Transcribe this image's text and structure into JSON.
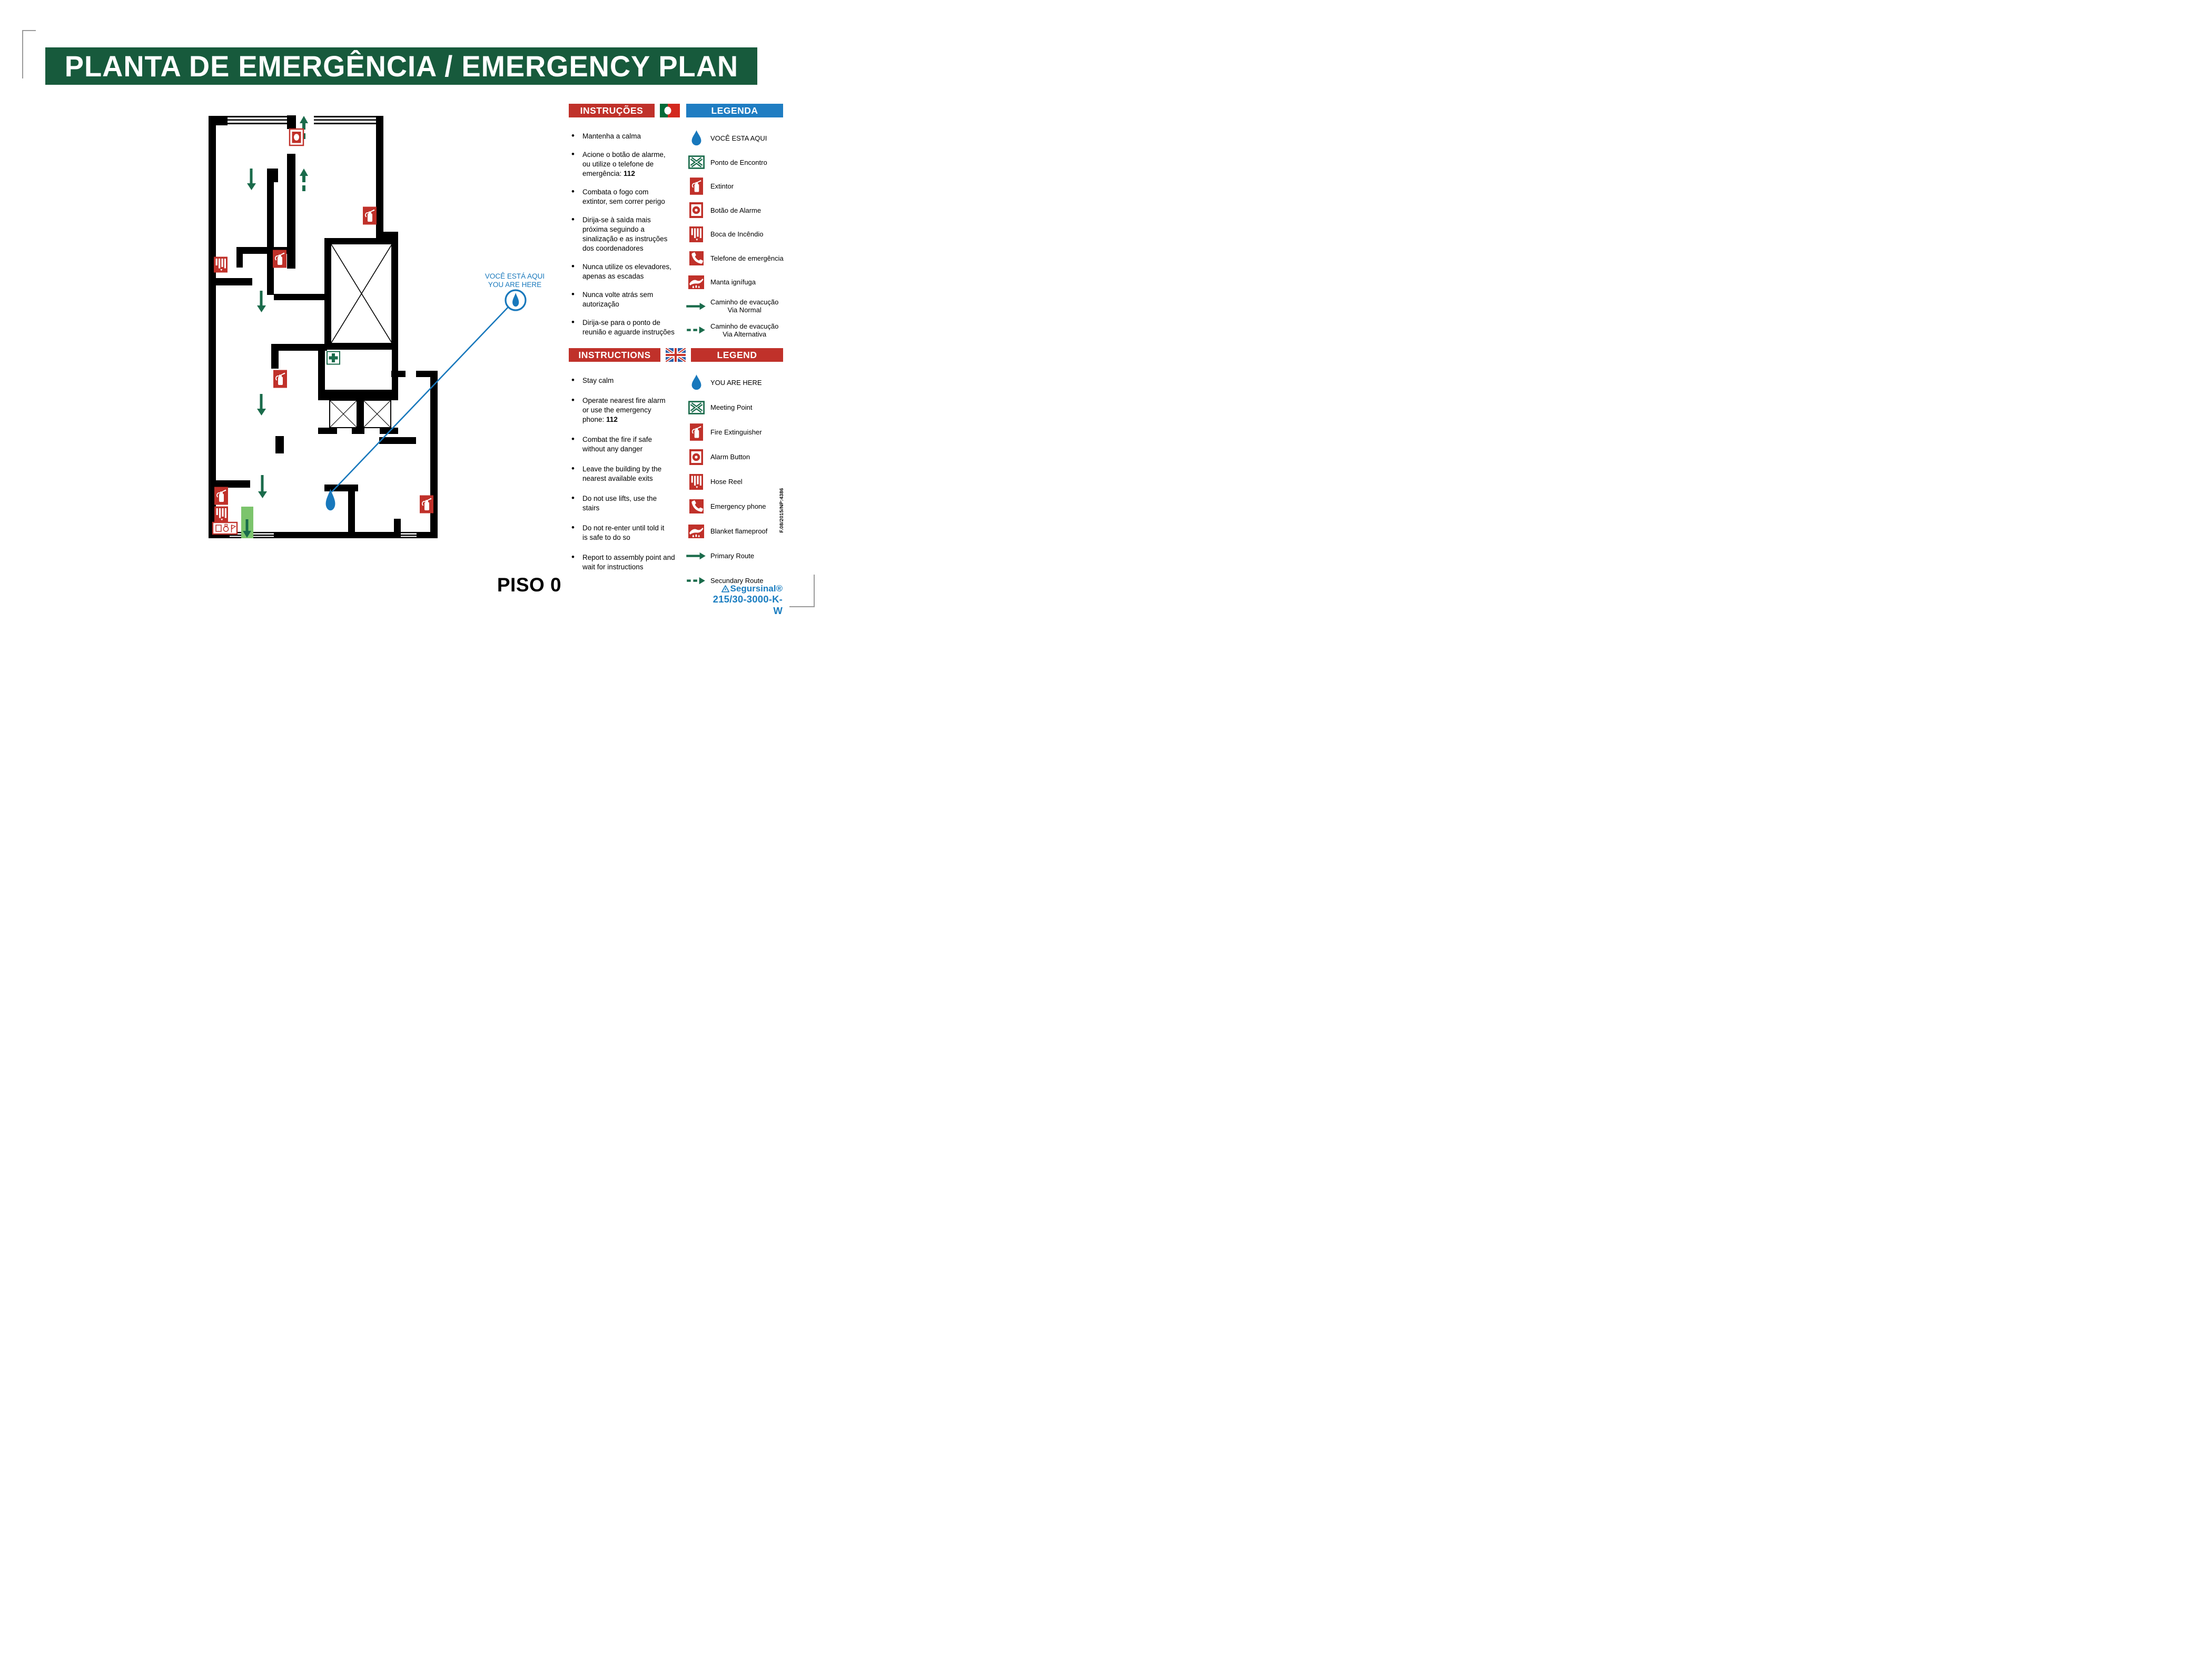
{
  "title": "PLANTA DE EMERGÊNCIA / EMERGENCY PLAN",
  "floor_label": "PISO 0",
  "you_are_here": {
    "line1": "VOCÊ ESTÁ AQUI",
    "line2": "YOU ARE HERE"
  },
  "panels": {
    "pt": {
      "instructions_header": "INSTRUÇÕES",
      "legend_header": "LEGENDA",
      "instructions": [
        {
          "text": "Mantenha a calma"
        },
        {
          "text": "Acione o botão de alarme,\nou utilize o telefone de\nemergência: **112**"
        },
        {
          "text": "Combata o fogo com\nextintor, sem correr perigo"
        },
        {
          "text": "Dirija-se à saìda mais\npróxima seguindo a\nsinalização e as instruções\ndos coordenadores"
        },
        {
          "text": "Nunca utilize os elevadores,\napenas as escadas"
        },
        {
          "text": "Nunca volte atrás sem\nautorização"
        },
        {
          "text": "Dirija-se para o ponto de\nreunião e aguarde instruções"
        }
      ],
      "legend": [
        {
          "icon": "drop",
          "label": "VOCÊ ESTA AQUI"
        },
        {
          "icon": "meeting",
          "label": "Ponto de Encontro"
        },
        {
          "icon": "ext",
          "label": "Extintor"
        },
        {
          "icon": "alarm",
          "label": "Botão de Alarme"
        },
        {
          "icon": "hose",
          "label": "Boca de Incêndio"
        },
        {
          "icon": "phone",
          "label": "Telefone de emergência"
        },
        {
          "icon": "manta",
          "label": "Manta ignífuga"
        },
        {
          "icon": "arrow-solid",
          "label": "Caminho de evacução\nVia Normal"
        },
        {
          "icon": "arrow-dash",
          "label": "Caminho de evacução\nVia Alternativa"
        }
      ]
    },
    "en": {
      "instructions_header": "INSTRUCTIONS",
      "legend_header": "LEGEND",
      "instructions": [
        {
          "text": "Stay calm"
        },
        {
          "text": "Operate nearest fire alarm\nor use the emergency\nphone: **112**"
        },
        {
          "text": "Combat the fire if safe\nwithout any danger"
        },
        {
          "text": "Leave the building by the\nnearest available exits"
        },
        {
          "text": "Do not use lifts, use the\nstairs"
        },
        {
          "text": "Do not re-enter until told it\nis safe to do so"
        },
        {
          "text": "Report to assembly point and\nwait for instructions"
        }
      ],
      "legend": [
        {
          "icon": "drop",
          "label": "YOU ARE HERE"
        },
        {
          "icon": "meeting",
          "label": "Meeting Point"
        },
        {
          "icon": "ext",
          "label": "Fire Extinguisher"
        },
        {
          "icon": "alarm",
          "label": "Alarm Button"
        },
        {
          "icon": "hose",
          "label": "Hose Reel"
        },
        {
          "icon": "phone",
          "label": "Emergency phone"
        },
        {
          "icon": "manta",
          "label": "Blanket flameproof"
        },
        {
          "icon": "arrow-solid",
          "label": "Primary Route"
        },
        {
          "icon": "arrow-dash",
          "label": "Secundary Route"
        }
      ]
    }
  },
  "footer": {
    "doc_ref": "F.08/2015/NP:4386",
    "brand": "Segursinal®",
    "model": "215/30-3000-K-W"
  },
  "colors": {
    "banner_green": "#175a3c",
    "icon_green": "#1a6b4b",
    "exit_green_light": "#7cc46c",
    "safety_red": "#c0312a",
    "legend_blue": "#1f7dc2",
    "marker_blue": "#1878bc"
  }
}
